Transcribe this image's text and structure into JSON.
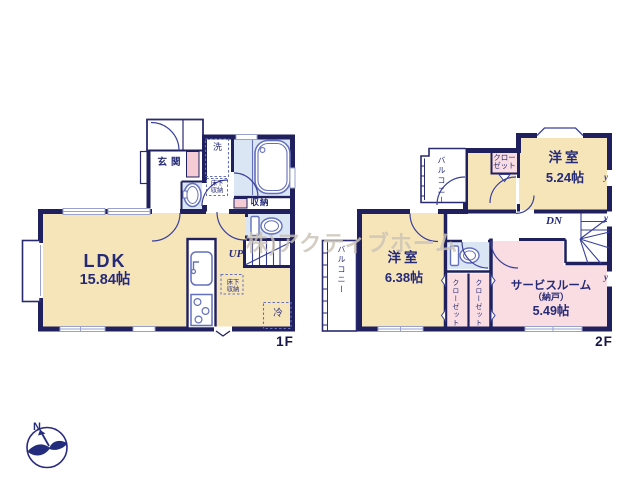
{
  "watermark": {
    "text": "株)アクティブホーム"
  },
  "compass": {
    "label": "N"
  },
  "colors": {
    "wall": "#20205f",
    "room_tan": "#f7e5ba",
    "room_pink": "#fadde2",
    "room_blue": "#dbe6f5",
    "line": "#39409a"
  },
  "floor1": {
    "label": "1F",
    "ldk": {
      "name": "LDK",
      "area": "15.84帖"
    },
    "genkan": {
      "name": "玄関"
    },
    "laundry": {
      "name": "洗"
    },
    "underfloor_laundry": {
      "name": "床下収納"
    },
    "storage": {
      "name": "収納"
    },
    "underfloor_ldk": {
      "name": "床下収納"
    },
    "fridge": {
      "name": "冷"
    },
    "stairs": {
      "direction": "UP"
    }
  },
  "floor2": {
    "label": "2F",
    "bedroom_a": {
      "name": "洋室",
      "area": "5.24帖"
    },
    "bedroom_b": {
      "name": "洋室",
      "area": "6.38帖"
    },
    "service_room": {
      "name": "サービスルーム",
      "alias": "（納戸）",
      "area": "5.49帖"
    },
    "closet_a": {
      "name": "クローゼット"
    },
    "closet_b": {
      "name": "クローゼット"
    },
    "closet_c": {
      "name": "クローゼット"
    },
    "balcony_a": {
      "name": "バルコニー"
    },
    "balcony_b": {
      "name": "バルコニー"
    },
    "stairs": {
      "direction": "DN"
    },
    "window_symbol": "y"
  }
}
